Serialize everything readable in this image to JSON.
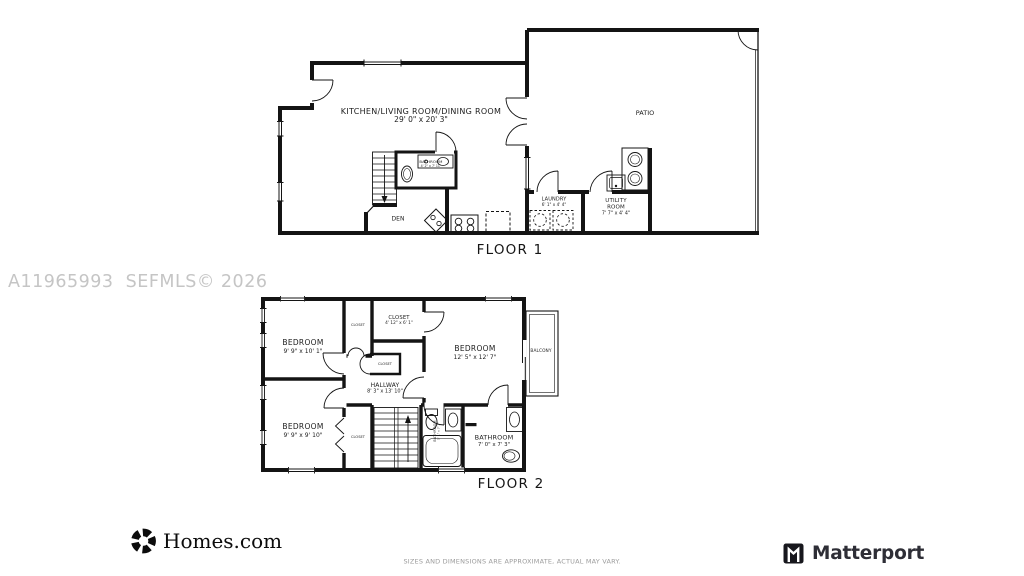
{
  "watermark": "A11965993  SEFMLS© 2026",
  "floor1": {
    "title": "FLOOR 1",
    "kitchen_living_dining": {
      "label": "KITCHEN/LIVING ROOM/DINING ROOM",
      "dims": "29' 0\" x 20' 3\""
    },
    "patio": {
      "label": "PATIO"
    },
    "bathroom": {
      "label": "BATHROOM",
      "dims": "4' 2\" x 7' 11\""
    },
    "den": {
      "label": "DEN"
    },
    "laundry": {
      "label": "LAUNDRY",
      "dims": "6' 1\" x 4' 4\""
    },
    "utility_room": {
      "label": "UTILITY ROOM",
      "dims": "7' 7\" x 4' 4\""
    }
  },
  "floor2": {
    "title": "FLOOR 2",
    "bedroom_top_left": {
      "label": "BEDROOM",
      "dims": "9' 9\" x 10' 1\""
    },
    "bedroom_bottom_left": {
      "label": "BEDROOM",
      "dims": "9' 9\" x 9' 10\""
    },
    "bedroom_right": {
      "label": "BEDROOM",
      "dims": "12' 5\" x 12' 7\""
    },
    "closet_top": {
      "label": "CLOSET"
    },
    "closet_main": {
      "label": "CLOSET",
      "dims": "4' 12\" x 6' 1\""
    },
    "closet_center": {
      "label": "CLOSET"
    },
    "closet_bottom": {
      "label": "CLOSET"
    },
    "hallway": {
      "label": "HALLWAY",
      "dims": "8' 3\" x 13' 10\""
    },
    "bathroom_middle": {
      "label": "BATHROOM",
      "dims": "5' 1\" x 7' 2\""
    },
    "bathroom_right": {
      "label": "BATHROOM",
      "dims": "7' 0\" x 7' 3\""
    },
    "balcony": {
      "label": "BALCONY"
    }
  },
  "footer": {
    "homes_logo_text": "Homes.com",
    "matterport_logo_text": "Matterport",
    "disclaimer": "SIZES AND DIMENSIONS ARE APPROXIMATE, ACTUAL MAY VARY."
  },
  "colors": {
    "wall": "#141414",
    "watermark": "#c5c5c5",
    "muted_gray": "#9b9b9b"
  }
}
